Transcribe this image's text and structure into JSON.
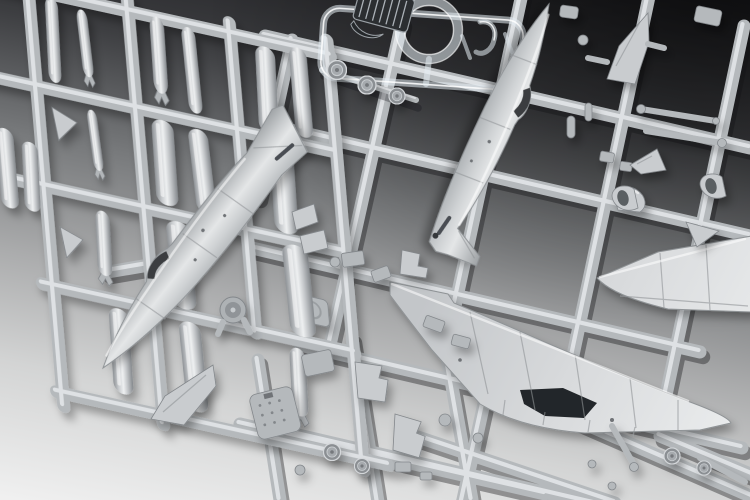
{
  "scene": {
    "description": "Overhead studio photograph of gray injection-molded plastic model aircraft kit sprues (parts trees) overlapping on a backdrop that fades from dark gray at the top to white at the bottom left. No text is visible in the image.",
    "colors": {
      "bg_dark": "#1b1b1e",
      "bg_mid": "#77797b",
      "bg_light": "#f6f6f6",
      "plastic_base": "#b5b9bc",
      "plastic_light": "#c9cccf",
      "plastic_highlight": "#e9ebed",
      "plastic_shadow": "#83878b",
      "clear_part": "rgba(230,238,244,0.55)",
      "panel_dark": "#2b2e31",
      "cockpit_dark": "#3b3e41"
    },
    "parts": {
      "backdrop": {
        "label": "studio backdrop gradient, dark at top fading to white at bottom"
      },
      "weapons_sprue": {
        "label": "sprue frame with drop tanks, bombs and missiles, top left"
      },
      "drop_tank": {
        "label": "drop tank / bomb ordnance piece"
      },
      "fin_piece": {
        "label": "small tail fin piece"
      },
      "main_sprue": {
        "label": "large main sprue lattice of runners"
      },
      "clear_sprue": {
        "label": "clear transparent parts sprue, top center"
      },
      "gunsight_ring": {
        "label": "clear ring part"
      },
      "instrument_panel": {
        "label": "dark ribbed instrument panel part"
      },
      "windscreen_part": {
        "label": "small clear windscreen part"
      },
      "fuselage_left": {
        "label": "left fuselage half with tail fin and cockpit opening"
      },
      "fuselage_right": {
        "label": "second fuselage half running from top edge"
      },
      "cockpit_opening": {
        "label": "dark cockpit opening"
      },
      "vertical_stabilizer": {
        "label": "separate vertical stabilizer part"
      },
      "lower_wing": {
        "label": "one-piece lower wing with center cutout"
      },
      "wheel_well_cutout": {
        "label": "dark wheel-well / fuselage cutout in wing"
      },
      "upper_wing": {
        "label": "upper wing half at right edge"
      },
      "wheel": {
        "label": "main wheel part"
      },
      "engine_disc": {
        "label": "round engine-face part"
      },
      "ejection_seat": {
        "label": "ejection seat part"
      },
      "cockpit_plate": {
        "label": "textured cockpit floor plate"
      },
      "gear_strut": {
        "label": "landing gear strut"
      },
      "intake_scoop": {
        "label": "air intake scoop part"
      },
      "wedge_part": {
        "label": "small wedge / intake ramp part"
      },
      "small_part": {
        "label": "small detail part"
      }
    }
  }
}
